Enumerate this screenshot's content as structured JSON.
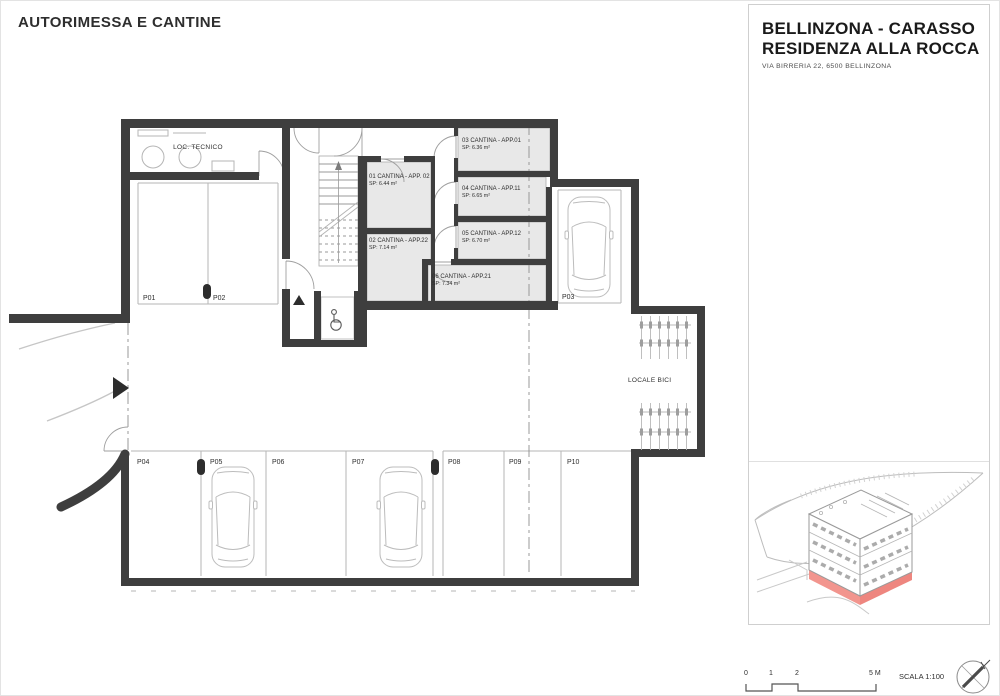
{
  "title": "AUTORIMESSA E CANTINE",
  "rooms": {
    "loc_tecnico": "LOC. TECNICO",
    "locale_bici": "LOCALE BICI"
  },
  "cantinas": [
    {
      "label": "01 CANTINA - APP. 02",
      "area": "SP: 6.44 m²"
    },
    {
      "label": "02 CANTINA - APP.22",
      "area": "SP: 7.14 m²"
    },
    {
      "label": "03 CANTINA - APP.01",
      "area": "SP: 6.36 m²"
    },
    {
      "label": "04 CANTINA - APP.11",
      "area": "SP: 6.65 m²"
    },
    {
      "label": "05 CANTINA - APP.12",
      "area": "SP: 6.70 m²"
    },
    {
      "label": "06 CANTINA - APP.21",
      "area": "SP: 7.34 m²"
    }
  ],
  "parking": [
    "P01",
    "P02",
    "P03",
    "P04",
    "P05",
    "P06",
    "P07",
    "P08",
    "P09",
    "P10"
  ],
  "panel": {
    "title_line1": "BELLINZONA - CARASSO",
    "title_line2": "RESIDENZA ALLA ROCCA",
    "address": "VIA BIRRERIA 22, 6500 BELLINZONA"
  },
  "scalebar": {
    "labels": [
      "0",
      "1",
      "2",
      "5 M"
    ],
    "scale": "SCALA 1:100"
  },
  "colors": {
    "wall": "#3e3e3e",
    "room_fill": "#e8e8e8",
    "thin_line": "#b3b3b3",
    "accent_red": "#ef8c84"
  }
}
